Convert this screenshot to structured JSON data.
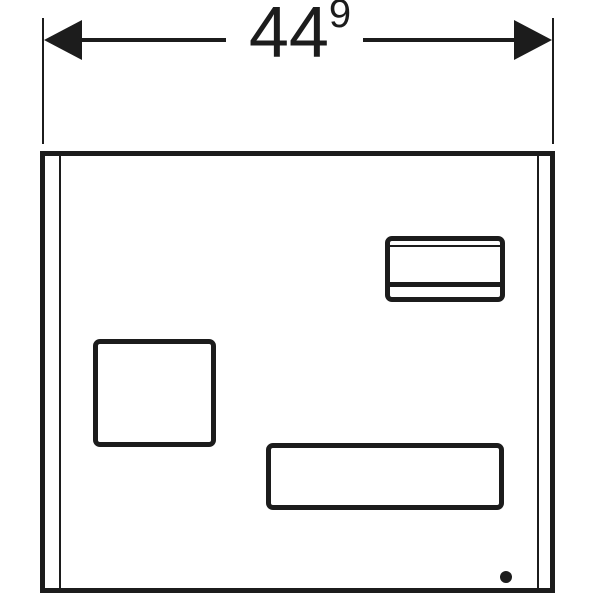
{
  "dimension": {
    "value": "44",
    "superscript": "9"
  },
  "colors": {
    "line": "#1c1c1c",
    "background": "#ffffff"
  },
  "icons": {
    "arrow_left": "left-pointing solid arrowhead",
    "arrow_right": "right-pointing solid arrowhead",
    "drill_dot": "small filled circle"
  }
}
